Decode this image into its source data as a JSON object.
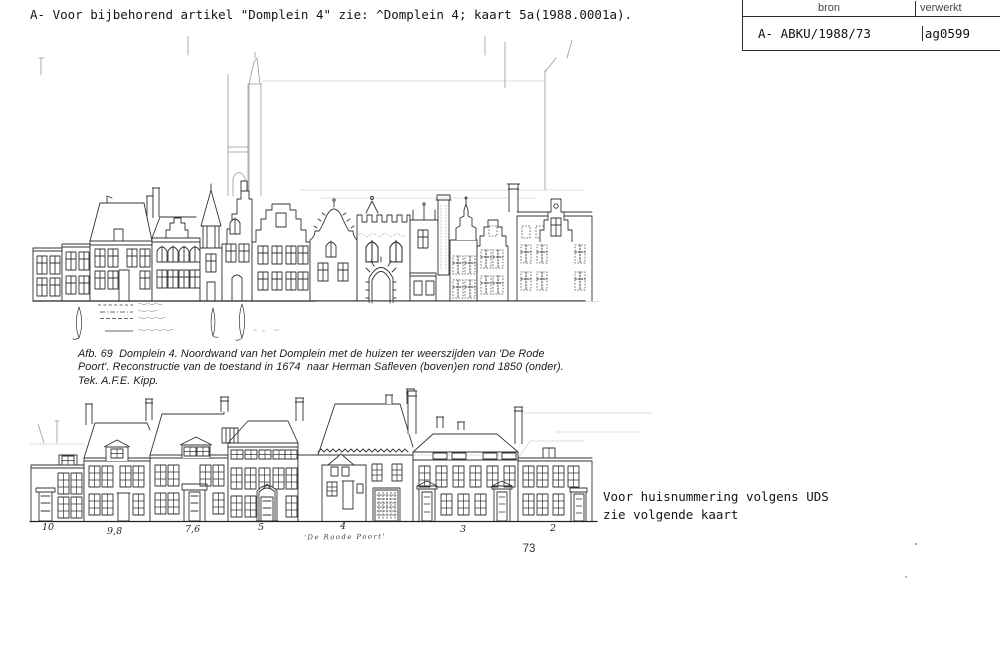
{
  "page": {
    "header_note": "A- Voor bijbehorend artikel \"Domplein 4\" zie: ^Domplein 4; kaart 5a(1988.0001a).",
    "page_number": "73"
  },
  "register_table": {
    "col_bron_label": "bron",
    "col_verwerkt_label": "verwerkt",
    "bron_value": "A- ABKU/1988/73",
    "verwerkt_value": "ag0599"
  },
  "figure_caption": {
    "line1": "Afb. 69  Domplein 4. Noordwand van het Domplein met de huizen ter weerszijden van 'De Rode",
    "line2": "Poort'. Reconstructie van de toestand in 1674  naar Herman Safleven (boven)en rond 1850 (onder).",
    "line3": "Tek. A.F.E. Kipp."
  },
  "elevation_1850": {
    "house_numbers": [
      {
        "label": "10"
      },
      {
        "label": "9,8"
      },
      {
        "label": "7,6"
      },
      {
        "label": "5"
      },
      {
        "label": "4"
      },
      {
        "label": "3"
      },
      {
        "label": "2"
      }
    ],
    "gate_label": "'De Roode Poort'"
  },
  "side_note": {
    "line1": "Voor huisnummering volgens UDS",
    "line2": "zie volgende kaart"
  }
}
